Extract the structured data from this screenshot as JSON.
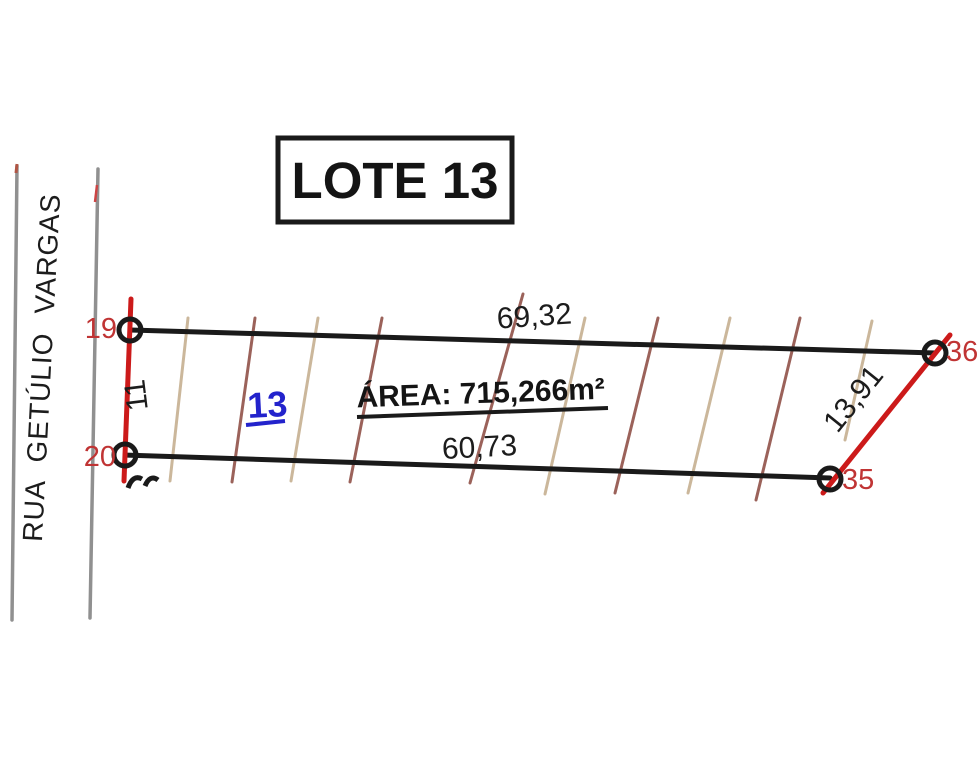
{
  "drawing": {
    "title": "LOTE 13",
    "street_name": "RUA GETÚLIO VARGAS",
    "lot_number": "13",
    "area_label": "ÁREA: 715,266m²"
  },
  "dimensions": {
    "front": "69,32",
    "back": "60,73",
    "left_side": "11",
    "right_side": "13,91"
  },
  "vertices": {
    "v19": "19",
    "v20": "20",
    "v35": "35",
    "v36": "36"
  },
  "colors": {
    "boundary_black": "#1a1a1a",
    "survey_red": "#cc1a1a",
    "vertex_label_red": "#c03434",
    "lot_number_blue": "#2323cc",
    "street_gray": "#909090",
    "hatch_tan": "#cbb79b",
    "hatch_brown": "#9b625a"
  }
}
